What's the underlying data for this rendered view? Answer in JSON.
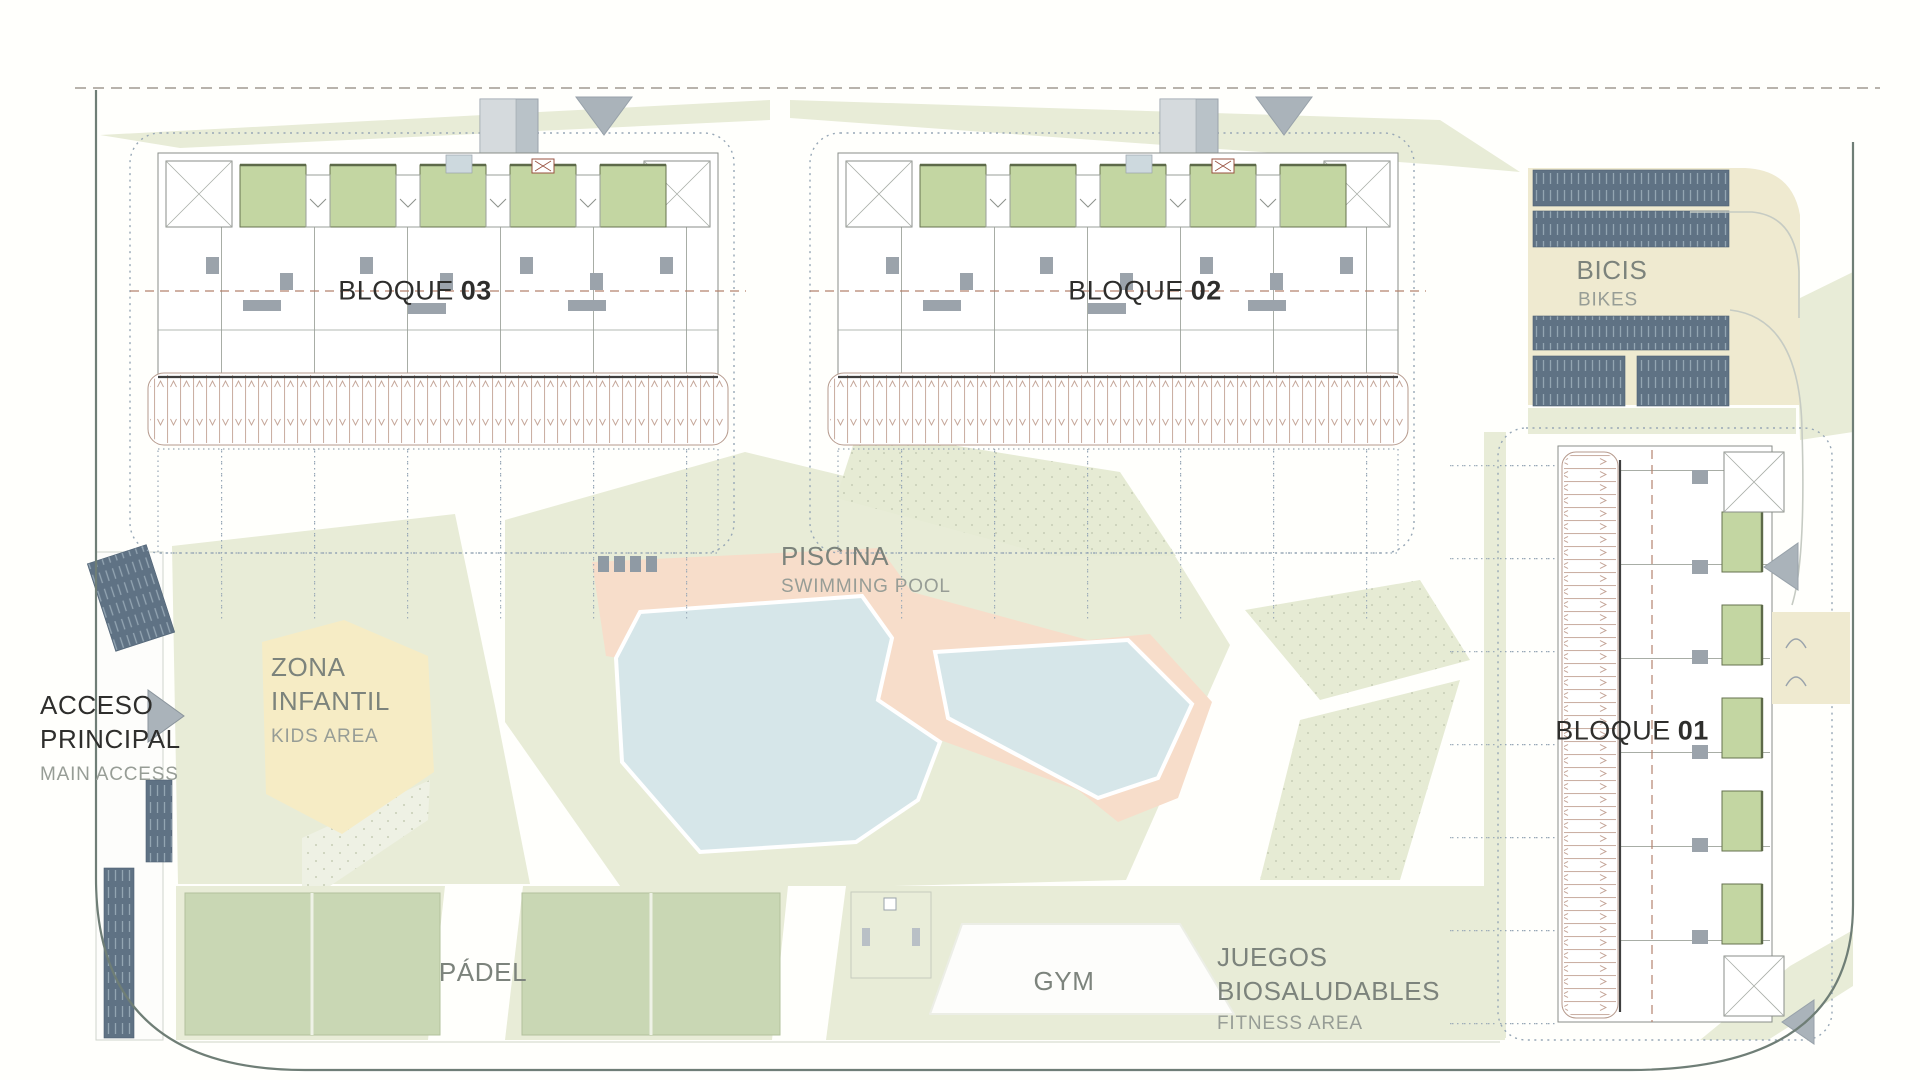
{
  "blocks": {
    "b03": {
      "label": "BLOQUE",
      "number": "03"
    },
    "b02": {
      "label": "BLOQUE",
      "number": "02"
    },
    "b01": {
      "label": "BLOQUE",
      "number": "01"
    }
  },
  "areas": {
    "bicis": {
      "es": "BICIS",
      "en": "BIKES"
    },
    "piscina": {
      "es": "PISCINA",
      "en": "SWIMMING POOL"
    },
    "zona_infantil": {
      "es_line1": "ZONA",
      "es_line2": "INFANTIL",
      "en": "KIDS AREA"
    },
    "acceso": {
      "es_line1": "ACCESO",
      "es_line2": "PRINCIPAL",
      "en": "MAIN ACCESS"
    },
    "padel": {
      "es": "PÁDEL"
    },
    "gym": {
      "es": "GYM"
    },
    "juegos": {
      "es_line1": "JUEGOS",
      "es_line2": "BIOSALUDABLES",
      "en": "FITNESS AREA"
    }
  },
  "colors": {
    "lawn": "#e8ecd7",
    "court_green": "#c9d7b4",
    "terrace_green": "#c3d6a2",
    "pool_water": "#d6e6e9",
    "pool_deck": "#f7ddca",
    "kids_yellow": "#f6ecc5",
    "bike_beige": "#efead0",
    "rack_slate": "#5f7284",
    "road_gray": "#aab3ba",
    "boundary": "#6f7e76",
    "label_gray": "#7c837c",
    "label_sub": "#979d96",
    "label_dark": "#2e2e2c",
    "dashed_accent": "#b5826e"
  }
}
